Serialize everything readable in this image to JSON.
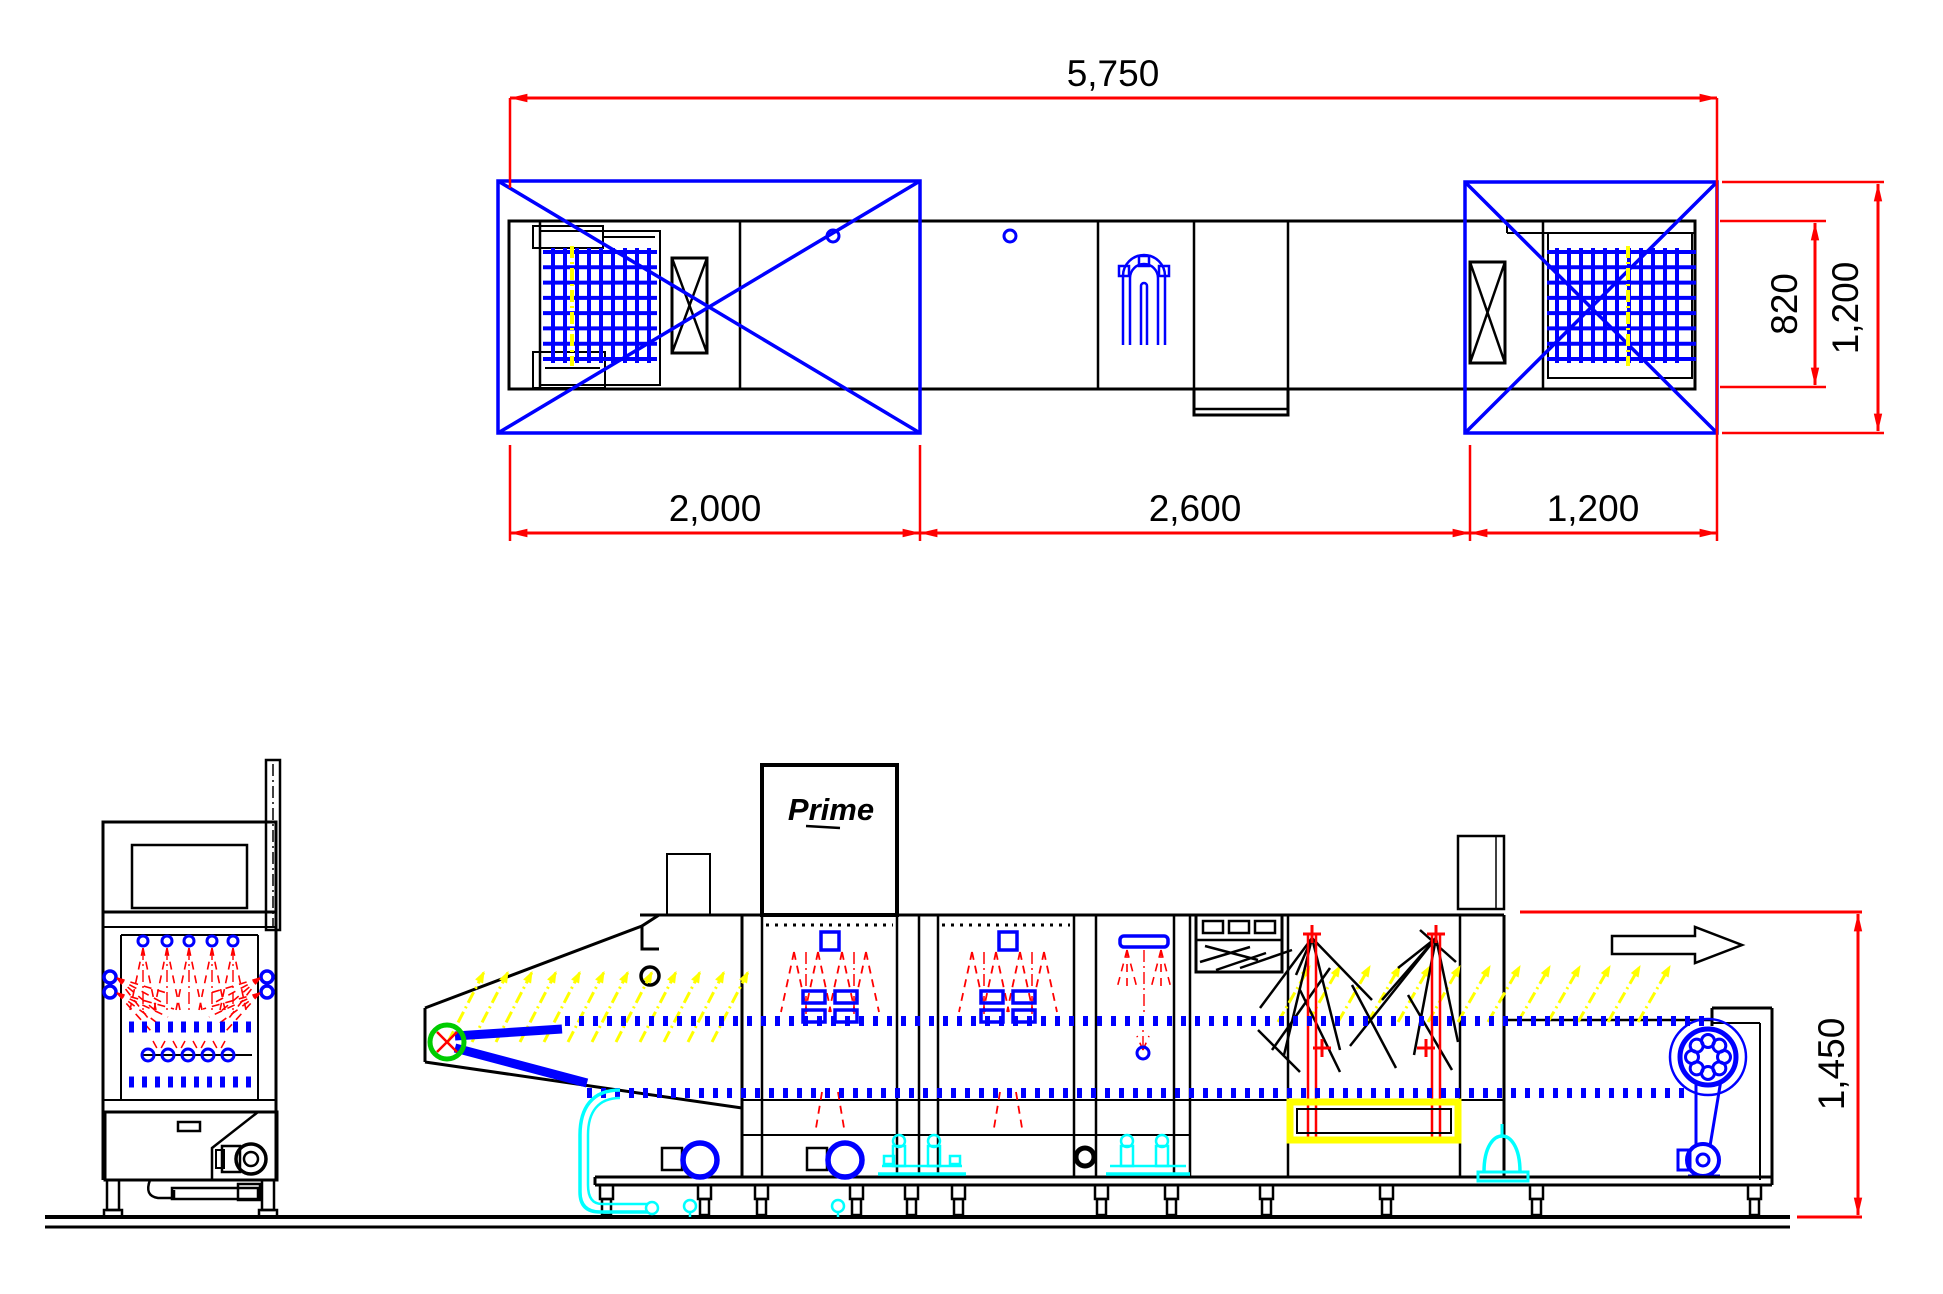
{
  "top_view": {
    "overall_length": "5,750",
    "section_lengths": [
      "2,000",
      "2,600",
      "1,200"
    ],
    "belt_width": "820",
    "module_width": "1,200"
  },
  "side_view": {
    "logo": "Prime",
    "overall_height": "1,450"
  },
  "colors": {
    "outline": "#000000",
    "machine_parts": "#0000ff",
    "dimensions_and_spray": "#ff0000",
    "highlight": "#ffff00",
    "plumbing": "#00ffff",
    "sprocket": "#00cc00",
    "background": "#ffffff"
  }
}
